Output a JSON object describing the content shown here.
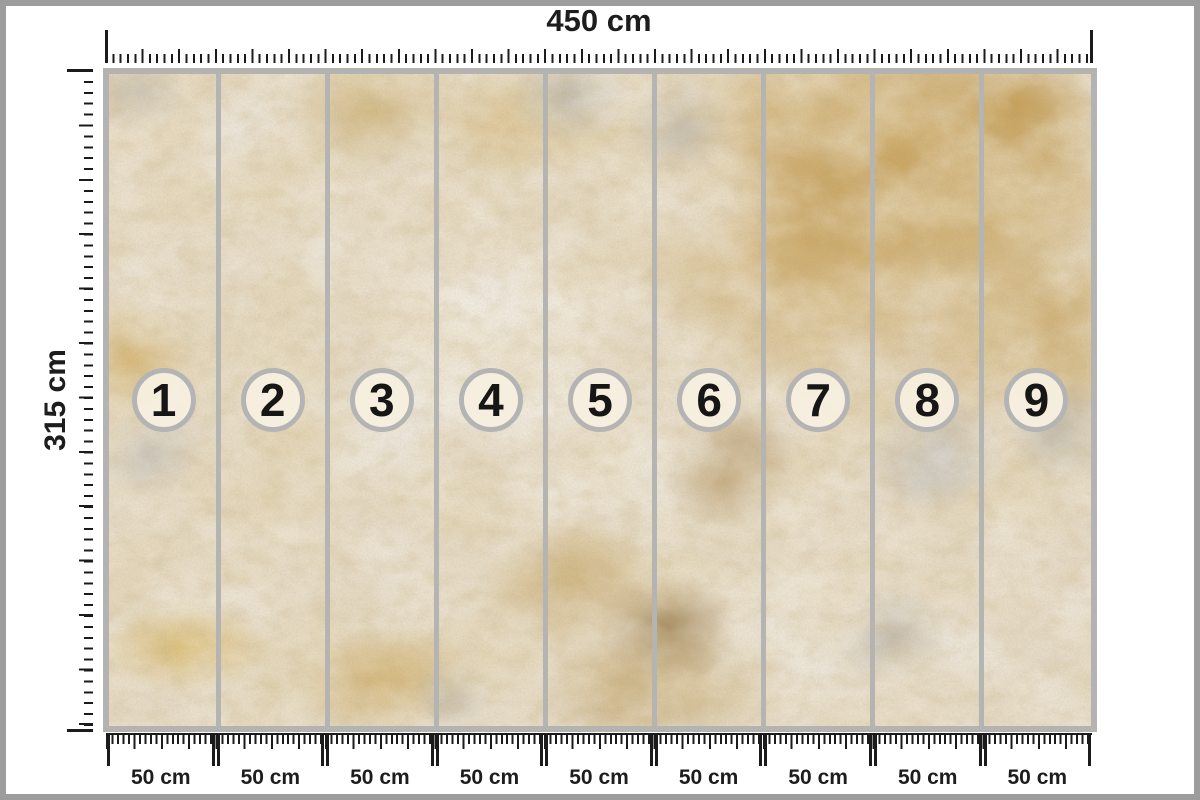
{
  "product": {
    "description": "Wallpaper mural dimension mockup with gold plaster texture"
  },
  "rulers": {
    "top": {
      "label": "450 cm"
    },
    "left": {
      "label": "315 cm"
    },
    "bottom": {
      "segments": [
        {
          "label": "50 cm"
        },
        {
          "label": "50 cm"
        },
        {
          "label": "50 cm"
        },
        {
          "label": "50 cm"
        },
        {
          "label": "50 cm"
        },
        {
          "label": "50 cm"
        },
        {
          "label": "50 cm"
        },
        {
          "label": "50 cm"
        },
        {
          "label": "50 cm"
        }
      ]
    }
  },
  "mural": {
    "panel_count": 9,
    "panels": [
      {
        "number": "1"
      },
      {
        "number": "2"
      },
      {
        "number": "3"
      },
      {
        "number": "4"
      },
      {
        "number": "5"
      },
      {
        "number": "6"
      },
      {
        "number": "7"
      },
      {
        "number": "8"
      },
      {
        "number": "9"
      }
    ]
  },
  "colors": {
    "outer_border": "#9d9d9d",
    "mural_frame": "#b3b3b1",
    "panel_divider": "#b4b5b3",
    "badge_ring": "#b4b4b4",
    "badge_fill": "#f7efdf",
    "tick": "#1b1b1b",
    "texture_gold": "#c69e54",
    "texture_dark_gold": "#8f6f3a",
    "texture_gray": "#a8a9ab",
    "texture_cream": "#f2ede4"
  }
}
